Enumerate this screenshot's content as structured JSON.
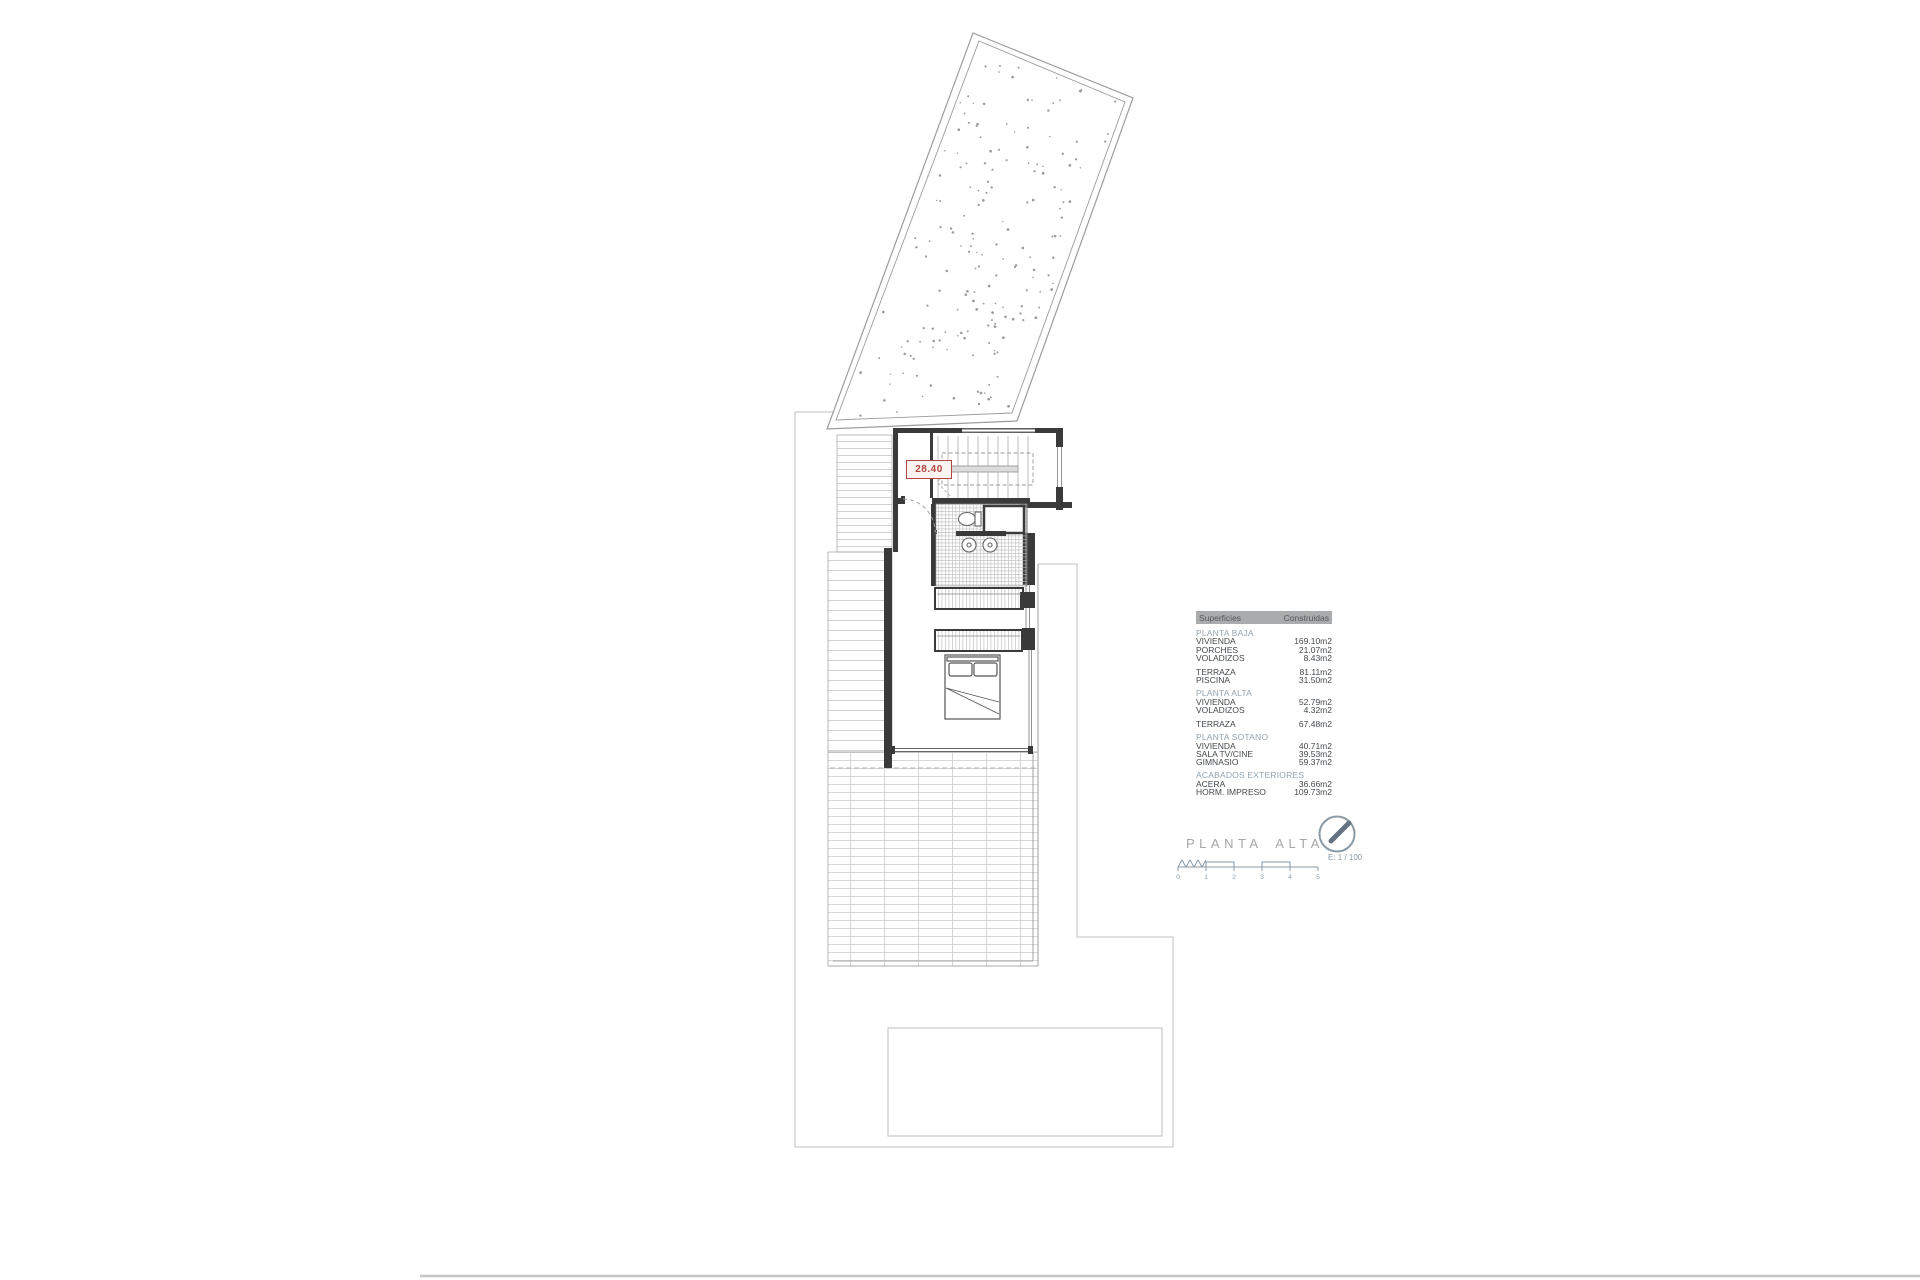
{
  "drawing": {
    "red_level_label": "28.40",
    "title": "PLANTA ALTA",
    "scale_text": "E: 1 / 100",
    "scale_ticks": [
      "0",
      "1",
      "2",
      "3",
      "4",
      "5"
    ]
  },
  "table": {
    "columns": [
      "Superficies",
      "Construidas"
    ],
    "entries": [
      {
        "t": "section",
        "label": "PLANTA BAJA"
      },
      {
        "t": "row",
        "label": "VIVIENDA",
        "value": "169.10m2"
      },
      {
        "t": "row",
        "label": "PORCHES",
        "value": "21.07m2"
      },
      {
        "t": "row",
        "label": "VOLADIZOS",
        "value": "8.43m2"
      },
      {
        "t": "spacer"
      },
      {
        "t": "row",
        "label": "TERRAZA",
        "value": "81.11m2"
      },
      {
        "t": "row",
        "label": "PISCINA",
        "value": "31.50m2"
      },
      {
        "t": "section",
        "label": "PLANTA ALTA"
      },
      {
        "t": "row",
        "label": "VIVIENDA",
        "value": "52.79m2"
      },
      {
        "t": "row",
        "label": "VOLADIZOS",
        "value": "4.32m2"
      },
      {
        "t": "spacer"
      },
      {
        "t": "row",
        "label": "TERRAZA",
        "value": "67.48m2"
      },
      {
        "t": "section",
        "label": "PLANTA SOTANO"
      },
      {
        "t": "row",
        "label": "VIVIENDA",
        "value": "40.71m2"
      },
      {
        "t": "row",
        "label": "SALA TV/CINE",
        "value": "39.53m2"
      },
      {
        "t": "row",
        "label": "GIMNASIO",
        "value": "59.37m2"
      },
      {
        "t": "section",
        "label": "ACABADOS EXTERIORES"
      },
      {
        "t": "row",
        "label": "ACERA",
        "value": "36.66m2"
      },
      {
        "t": "row",
        "label": "HORM. IMPRESO",
        "value": "109.73m2"
      }
    ]
  },
  "colors": {
    "accent_red": "#b0453f",
    "table_header_bg": "#a9abac",
    "section_text": "#93a3af",
    "wall": "#3a3a3a",
    "light_boundary": "#cdcdcd"
  }
}
